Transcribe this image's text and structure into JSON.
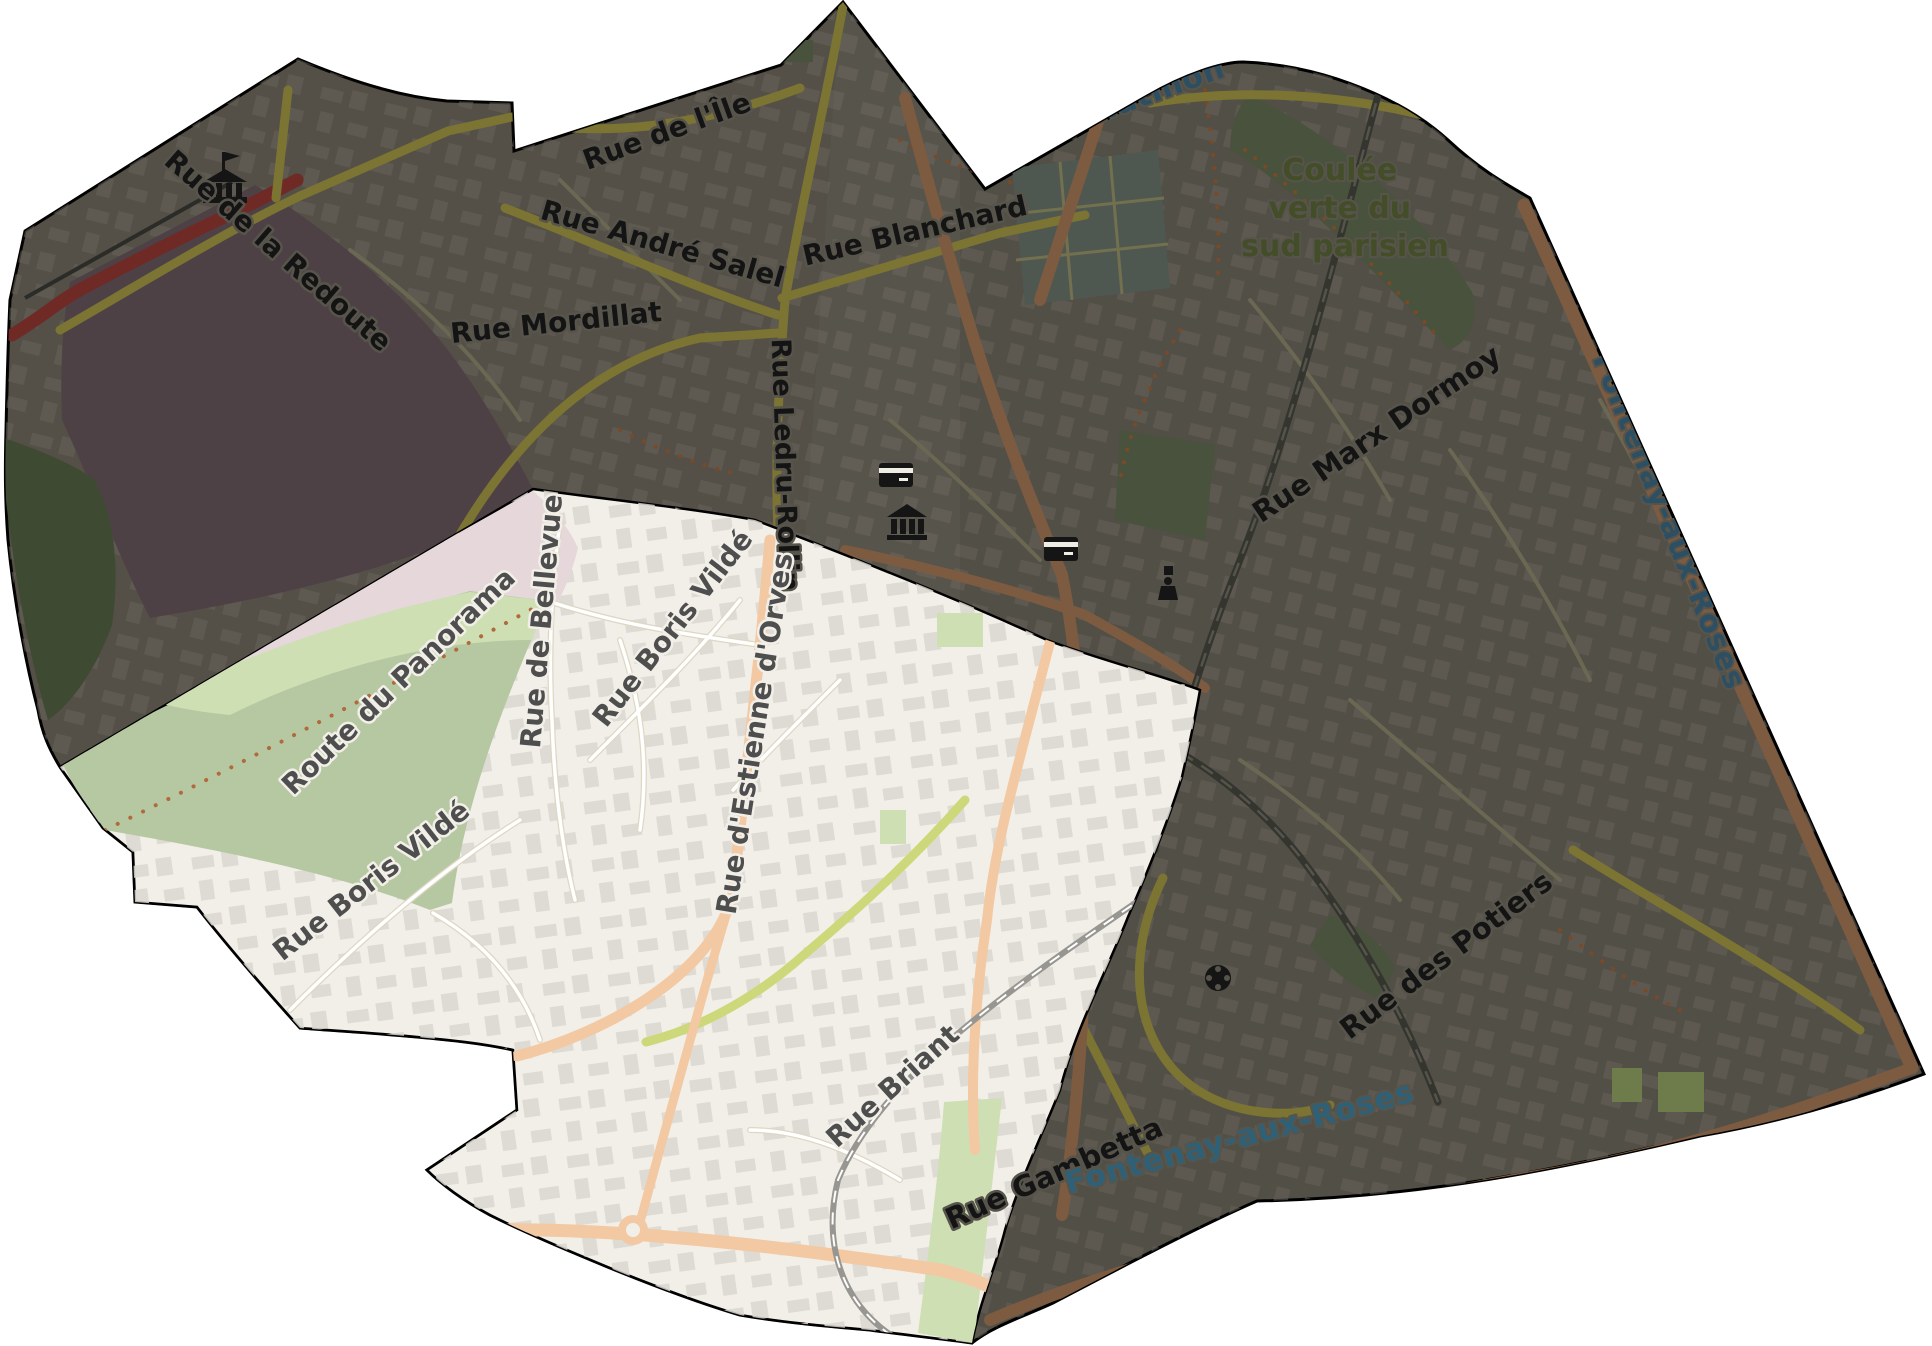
{
  "map": {
    "communes": {
      "partial_top": "Châtillon",
      "right": "Fontenay-aux-Roses",
      "bottom": "Fontenay-aux-Roses"
    },
    "park": {
      "line1": "Coulée",
      "line2": "verte du",
      "line3": "sud parisien"
    },
    "streets": {
      "ile": "Rue de l'Île",
      "salel": "Rue André Salel",
      "blanchard": "Rue Blanchard",
      "mordillat": "Rue Mordillat",
      "redoute": "Rue de la Redoute",
      "ledru": "Rue Ledru-Rollin",
      "marx": "Rue Marx Dormoy",
      "panorama": "Route du Panorama",
      "bellevue": "Rue de Bellevue",
      "boris_upper": "Rue Boris Vildé",
      "orves": "Rue d'Estienne d'Orves",
      "boris_lower": "Rue Boris Vildé",
      "briant": "Rue Briant",
      "gambetta": "Rue Gambetta",
      "potiers": "Rue des Potiers"
    },
    "icons": [
      {
        "name": "fort-icon"
      },
      {
        "name": "atm-icon"
      },
      {
        "name": "museum-icon"
      },
      {
        "name": "atm-icon"
      },
      {
        "name": "memorial-icon"
      },
      {
        "name": "water-tower-icon"
      }
    ],
    "colors": {
      "background": "#ffffff",
      "outline": "#000000",
      "dim_base": "#57544b",
      "dim_building": "#6b675f",
      "dim_green": "#49523c",
      "dim_green_dark": "#3f4a33",
      "dim_garden": "#4f5850",
      "fort_purple": "#4e4146",
      "pink_area": "#e5d7da",
      "highlight_bg": "#f2efe8",
      "highlight_building": "#dbd7d0",
      "green_light": "#cfdfb4",
      "green_sage": "#b6c8a2",
      "road_olive": "#7b7433",
      "road_brown": "#7d5b41",
      "road_red": "#6f2a25",
      "road_peach": "#f2c9a2",
      "road_lime": "#ccd87a",
      "road_white": "#ffffff",
      "rail_dark": "#35352f",
      "rail_light": "#989691",
      "label_dark": "#141414",
      "label_gray": "#4e4e4e",
      "label_teal": "#2c4f63",
      "label_teal_bright": "#2e6177",
      "label_green": "#434d28",
      "icon_black": "#151515"
    }
  }
}
